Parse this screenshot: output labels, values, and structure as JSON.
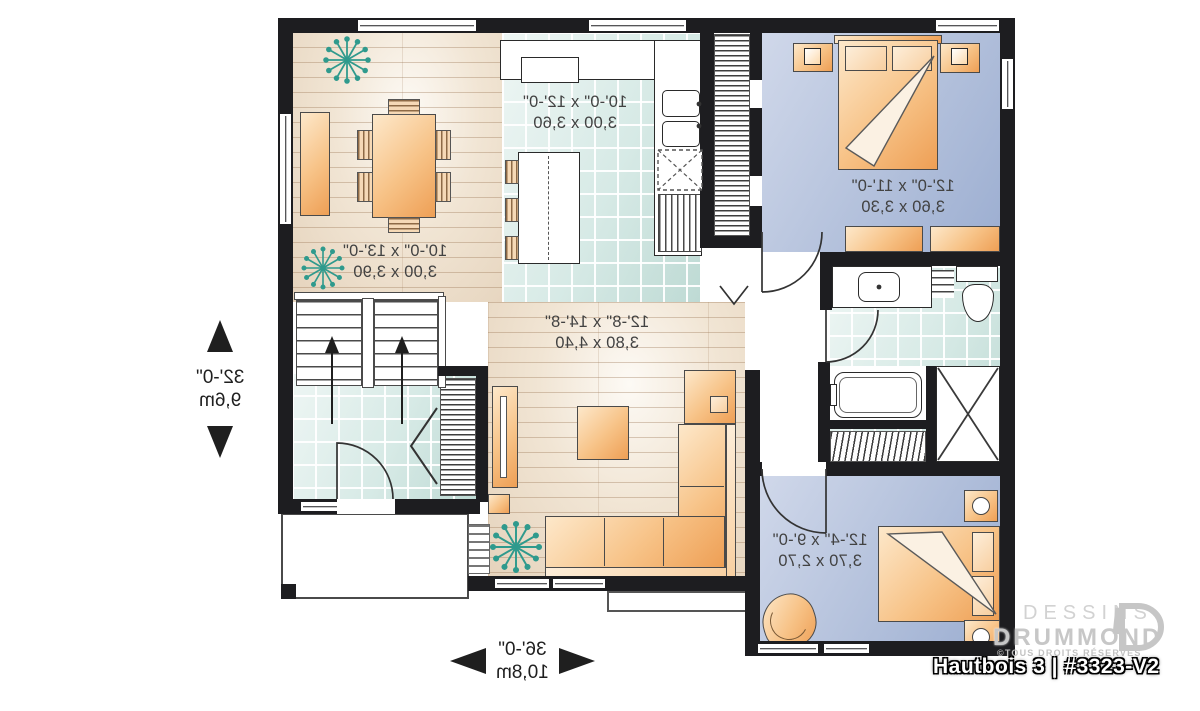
{
  "plan": {
    "title": "Hautbois 3 | #3323-V2",
    "brand": {
      "line1": "DESSINS",
      "line2": "DRUMMOND",
      "copyright": "©TOUS DROITS RÉSERVÉS"
    },
    "overall": {
      "width_imperial": "36'-0\"",
      "width_metric": "10,8m",
      "depth_imperial": "32'-0\"",
      "depth_metric": "9,6m"
    },
    "rooms": {
      "kitchen": {
        "imperial": "10'-0\" x 12'-0\"",
        "metric": "3,00 x 3,60"
      },
      "dining": {
        "imperial": "10'-0\" x 13'-0\"",
        "metric": "3,00 x 3,90"
      },
      "living": {
        "imperial": "12'-8\" x 14'-8\"",
        "metric": "3,80 x 4,40"
      },
      "master_bedroom": {
        "imperial": "12'-0\" x 11'-0\"",
        "metric": "3,60 x 3,30"
      },
      "bedroom_2": {
        "imperial": "12'-4\" x 9'-0\"",
        "metric": "3,70 x 2,70"
      }
    },
    "colors": {
      "wall": "#1d1d20",
      "wood_floor": "#ecdfce",
      "tile_floor": "#d7e9e6",
      "bedroom_floor": "#b9c5de",
      "furniture_accent": "#f0a55e",
      "plant": "#2f9a8d",
      "logo_gray": "#c9c9c9"
    }
  }
}
